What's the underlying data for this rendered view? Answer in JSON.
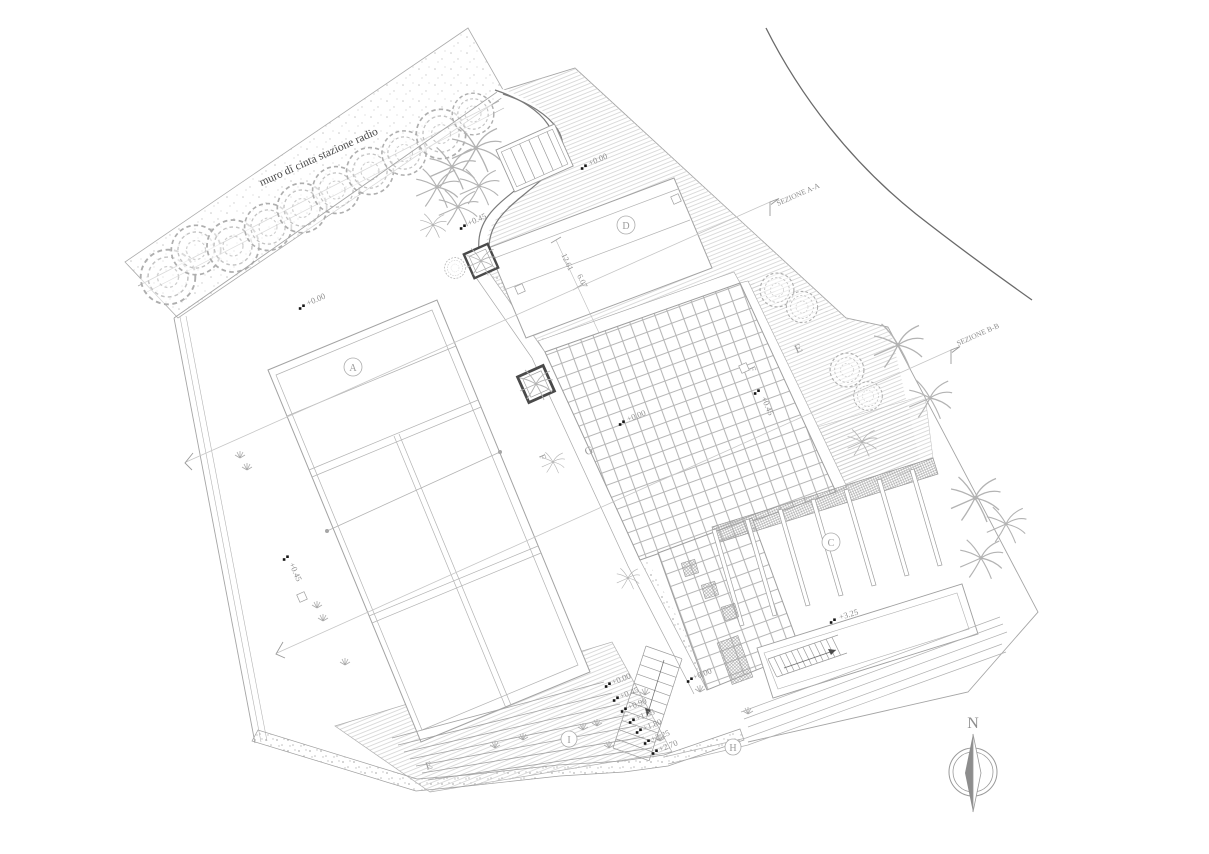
{
  "plan": {
    "wall_label": "muro di cinta stazione radio",
    "north_label": "N",
    "section_a_label": "SEZIONE A-A",
    "section_b_label": "SEZIONE B-B",
    "zones": {
      "a": "A",
      "c": "C",
      "d": "D",
      "e_upper": "E",
      "e_lower": "E",
      "f_west": "F",
      "f_east": "F",
      "g": "G",
      "h": "H",
      "i": "I"
    },
    "elevations": {
      "north_area": "+0.00",
      "entry": "+0.45",
      "west_lawn": "+0.00",
      "plaza": "+0.00",
      "west_path": "+0.45",
      "east_walk": "+0.45",
      "terrace": "+3.25",
      "plaza_south": "+0.00"
    },
    "steps": [
      "+0.00",
      "+0.45",
      "+0.90",
      "+1.35",
      "+1.80",
      "+2.25",
      "+2.70"
    ],
    "dimensions": {
      "length": "12.61",
      "width": "6.07"
    },
    "colors": {
      "paper": "#ffffff",
      "line": "#a9a9a9",
      "text": "#8d8d8d",
      "dark_border": "#3d3d3d",
      "road": "#5a5a5a"
    }
  }
}
